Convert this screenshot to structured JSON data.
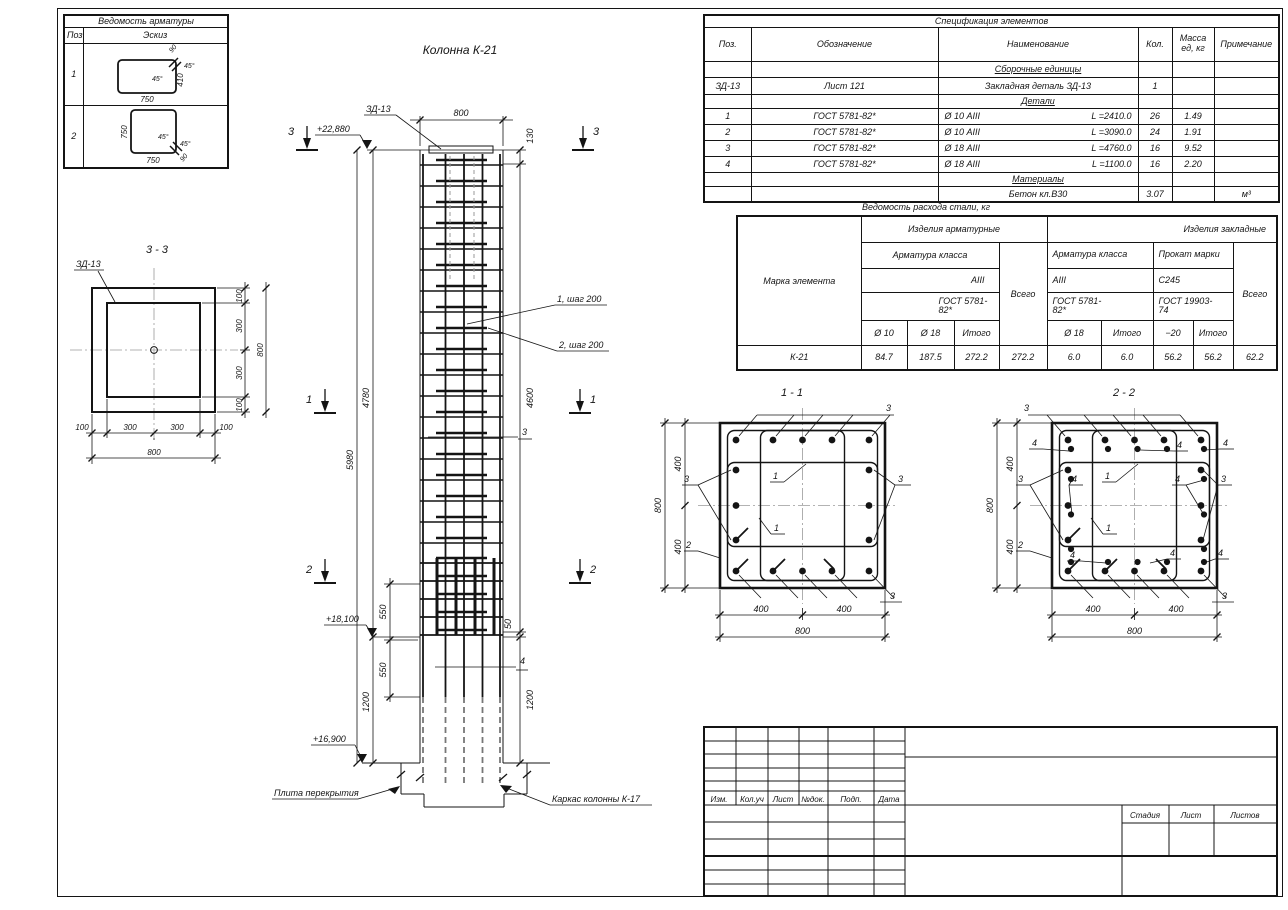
{
  "rebar_list": {
    "title": "Ведомость арматуры",
    "headers": {
      "pos": "Поз.",
      "sketch": "Эскиз"
    },
    "rows": [
      {
        "pos": "1",
        "dim_w": "750",
        "dim_h": "410",
        "angle_a": "45°",
        "angle_b": "45°",
        "hook": "90"
      },
      {
        "pos": "2",
        "dim_w": "750",
        "dim_h": "750",
        "angle_a": "45°",
        "angle_b": "45°",
        "hook": "90"
      }
    ]
  },
  "spec": {
    "title": "Спецификация элементов",
    "headers": {
      "pos": "Поз.",
      "designation": "Обозначение",
      "name": "Наименование",
      "qty": "Кол.",
      "mass": "Масса ед, кг",
      "note": "Примечание"
    },
    "group_assembly": "Сборочные единицы",
    "assembly_rows": [
      {
        "pos": "ЗД-13",
        "designation": "Лист 121",
        "name": "Закладная деталь ЗД-13",
        "qty": "1",
        "mass": "",
        "note": ""
      }
    ],
    "group_details": "Детали",
    "detail_rows": [
      {
        "pos": "1",
        "designation": "ГОСТ 5781-82*",
        "name": "Ø 10 АIII",
        "length": "L =2410.0",
        "qty": "26",
        "mass": "1.49",
        "note": ""
      },
      {
        "pos": "2",
        "designation": "ГОСТ 5781-82*",
        "name": "Ø 10 АIII",
        "length": "L =3090.0",
        "qty": "24",
        "mass": "1.91",
        "note": ""
      },
      {
        "pos": "3",
        "designation": "ГОСТ 5781-82*",
        "name": "Ø 18 АIII",
        "length": "L =4760.0",
        "qty": "16",
        "mass": "9.52",
        "note": ""
      },
      {
        "pos": "4",
        "designation": "ГОСТ 5781-82*",
        "name": "Ø 18 АIII",
        "length": "L =1100.0",
        "qty": "16",
        "mass": "2.20",
        "note": ""
      }
    ],
    "group_materials": "Материалы",
    "material_rows": [
      {
        "name": "Бетон кл.В30",
        "qty": "3.07",
        "note": "м³"
      }
    ]
  },
  "steel": {
    "title": "Ведомость расхода стали, кг",
    "mark_header": "Марка элемента",
    "group_rebar": "Изделия арматурные",
    "group_embed": "Изделия закладные",
    "rebar_class": "Арматура класса",
    "embed_class": "Арматура класса",
    "roll_mark": "Прокат марки",
    "class_a3_1": "АIII",
    "class_a3_2": "АIII",
    "steel_c245": "С245",
    "gost1": "ГОСТ 5781-82*",
    "gost2": "ГОСТ 5781-82*",
    "gost3": "ГОСТ 19903-74",
    "total_header_1": "Всего",
    "total_header_2": "Всего",
    "cols": {
      "d10": "Ø 10",
      "d18": "Ø 18",
      "itogo1": "Итого",
      "ed18": "Ø 18",
      "itogo2": "Итого",
      "sheet20": "−20",
      "itogo3": "Итого"
    },
    "row": {
      "mark": "К-21",
      "d10": "84.7",
      "d18": "187.5",
      "itogo1": "272.2",
      "vsego1": "272.2",
      "ed18": "6.0",
      "itogo2": "6.0",
      "sheet20": "56.2",
      "itogo3": "56.2",
      "vsego2": "62.2"
    }
  },
  "elevation": {
    "title": "Колонна К-21",
    "zd13": "ЗД-13",
    "dim_top": "800",
    "elev_top": "+22,880",
    "elev_mid": "+18,100",
    "elev_bot": "+16,900",
    "dim_130": "130",
    "dim_4600": "4600",
    "dim_4780": "4780",
    "dim_5980": "5980",
    "dim_550": "550",
    "dim_50": "50",
    "dim_1200": "1200",
    "step1": "1, шаг 200",
    "step2": "2, шаг 200",
    "mark_1": "1",
    "mark_2": "2",
    "mark_3": "3",
    "mark_4": "4",
    "slab_label": "Плита перекрытия",
    "frame_label": "Каркас колонны К-17"
  },
  "section33": {
    "title": "3 - 3",
    "zd13": "ЗД-13",
    "dim_100": "100",
    "dim_300": "300",
    "dim_800": "800"
  },
  "section11": {
    "title": "1 - 1",
    "dim_400": "400",
    "dim_800": "800",
    "mark_1": "1",
    "mark_2": "2",
    "mark_3": "3"
  },
  "section22": {
    "title": "2 - 2",
    "dim_400": "400",
    "dim_800": "800",
    "mark_1": "1",
    "mark_2": "2",
    "mark_3": "3",
    "mark_4": "4"
  },
  "titleblock": {
    "izm": "Изм.",
    "kol_uch": "Кол.уч",
    "list": "Лист",
    "n_dok": "№док.",
    "podp": "Подп.",
    "date": "Дата",
    "stadia": "Стадия",
    "sheet": "Лист",
    "sheets": "Листов"
  }
}
